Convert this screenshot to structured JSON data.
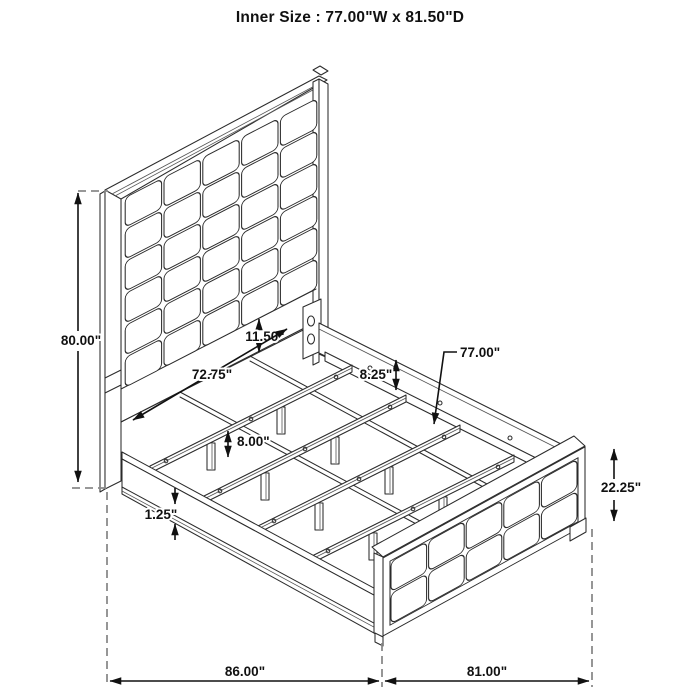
{
  "title": "Inner Size : 77.00\"W x 81.50\"D",
  "dimensions": {
    "headboard_height": {
      "label": "80.00\""
    },
    "headboard_rail": {
      "label": "11.50\""
    },
    "slat_length": {
      "label": "72.75\""
    },
    "side_rail_height": {
      "label": "8.25\""
    },
    "slat_span": {
      "label": "77.00\""
    },
    "leg_height": {
      "label": "8.00\""
    },
    "trim_height": {
      "label": "1.25\""
    },
    "footboard_height": {
      "label": "22.25\""
    },
    "overall_depth": {
      "label": "86.00\""
    },
    "overall_width": {
      "label": "81.00\""
    }
  },
  "headboard_grid": {
    "cols": 5,
    "rows": 6
  },
  "footboard_grid": {
    "cols": 5,
    "rows": 2
  },
  "colors": {
    "background": "#ffffff",
    "line": "#2b2b2b",
    "dimension": "#111111",
    "dashed": "#8a8a8a",
    "text": "#111111"
  }
}
